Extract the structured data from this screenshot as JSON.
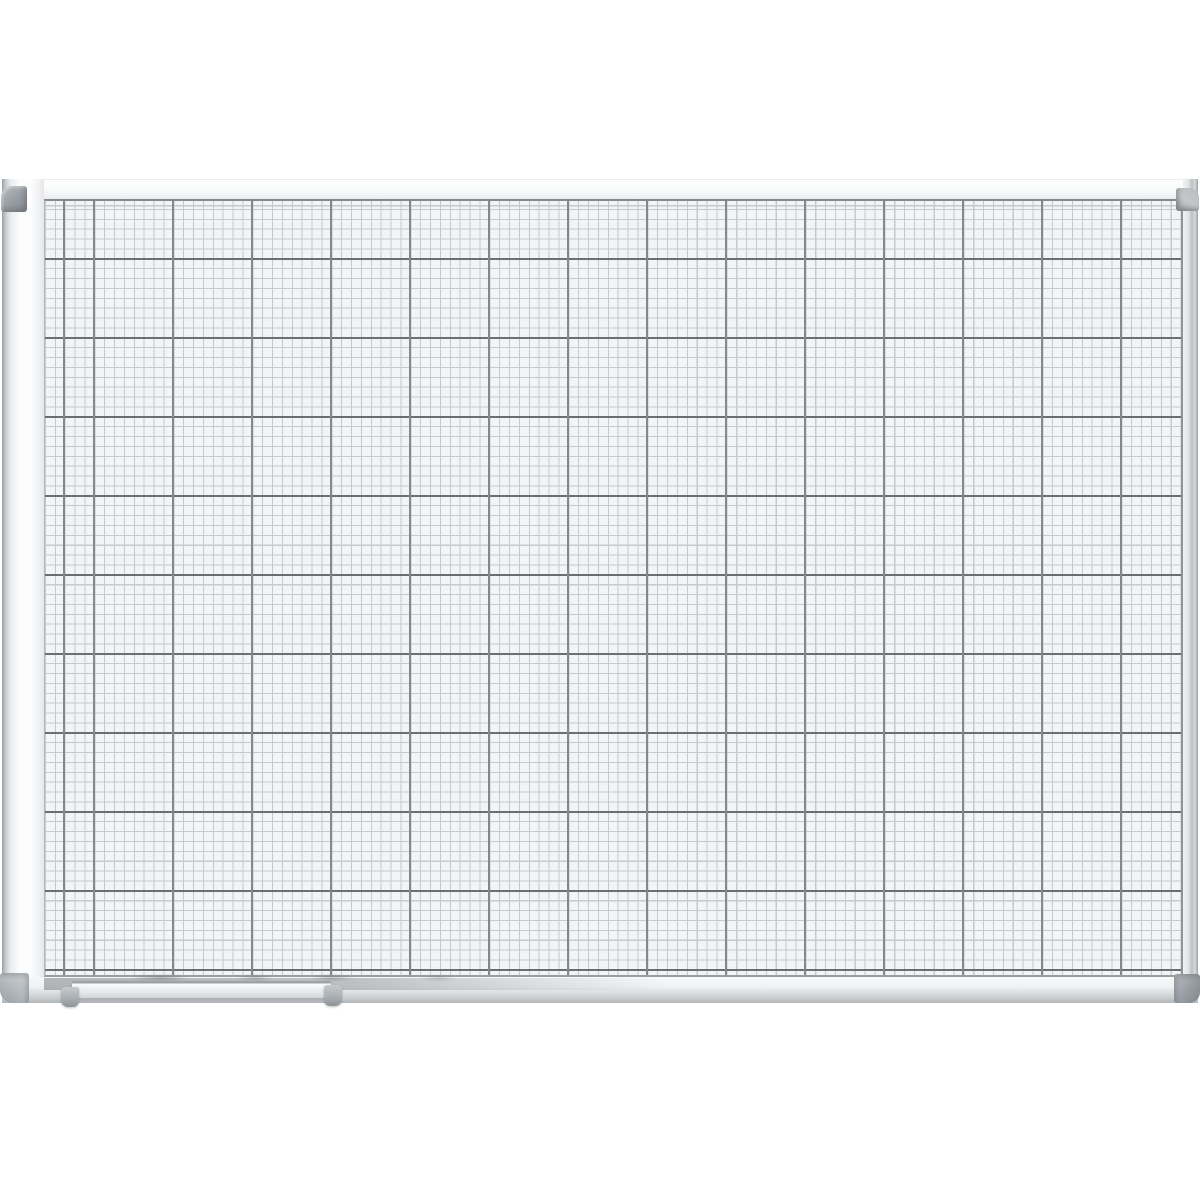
{
  "meta": {
    "alt": "Product photo of a white magnetic whiteboard with printed square grid, aluminium frame, grey plastic corner caps and a pen tray at the lower left"
  },
  "css_vars": {
    "--bg": "#ffffff",
    "--surface": "#f3f4f5",
    "--grid-fine": "#c7c9cc",
    "--grid-bold-v": "#84888c",
    "--grid-bold-h": "#6b6f73",
    "--cell": "9.875px",
    "--block": "79px",
    "--frame-face": "#fbfcfc",
    "--frame-edge": "#9fa3a7",
    "--cap-light": "#b8bdc1",
    "--cap-mid": "#9aa0a5",
    "--cap-dark": "#82878c",
    "--tray-face": "#eff1f3",
    "--tray-edge": "#9ea2a6"
  },
  "board": {
    "kind": "grid whiteboard",
    "grid_cells_per_block": 8,
    "fine_cell_px": 9.875,
    "block_px": 79
  }
}
